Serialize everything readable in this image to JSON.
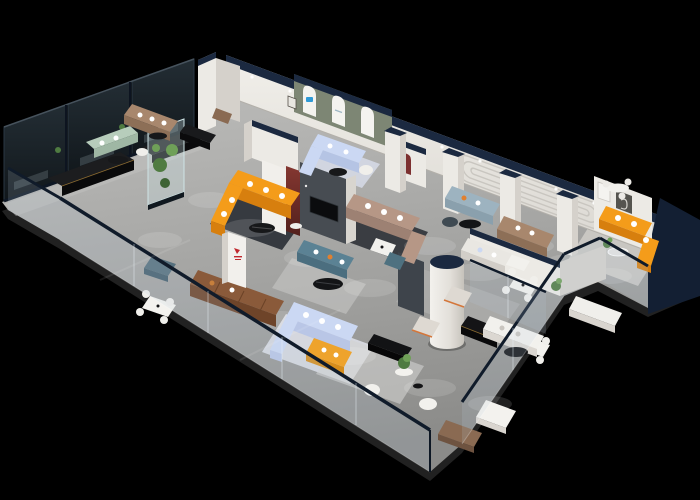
{
  "meta": {
    "description": "3D isometric cutaway render of a furniture showroom floor plan on a black background, with glass-walled display boxes, arched feature wall, glass front railing and many sofa vignettes",
    "canvas_width": "700",
    "canvas_height": "500"
  },
  "palette": {
    "background": "#000000",
    "floor_back": "#b6b6b4",
    "floor_front": "#8e8e8c",
    "slab": "#212121",
    "wall": "#eceae5",
    "wall_shade": "#d5d1cb",
    "navy": "#1b2940",
    "navy_dark": "#131f33",
    "rail": "#101b2a",
    "glass_tint": "rgba(185,208,224,0.16)",
    "glass_box": "#181f24",
    "arch_wall": "#7d8674",
    "accent_red": "#7c3030",
    "tv_wall": "#474c52",
    "sofa_orange": "#f49c1a",
    "sofa_orange_shade": "#d77f0e",
    "sofa_yellow": "#eea32c",
    "sofa_sage": "#b7cdbb",
    "sofa_tan": "#a8876d",
    "sofa_brown": "#8a5a3a",
    "sofa_lightblue": "#cbd8f3",
    "sofa_teal": "#5b8294",
    "sofa_mauve": "#b69786",
    "sofa_bluegray": "#9db3c0",
    "white_furniture": "#f2f1ed",
    "black_furniture": "#141416",
    "plant_green": "#4f7b41",
    "plant_green_light": "#6fa058",
    "wood": "#8a6a52",
    "logo_red": "#c0272d",
    "logo_blue": "#2f9ad6"
  },
  "scene": {
    "elements": [
      {
        "name": "showroom-floor",
        "color": "#a6a6a4"
      },
      {
        "name": "back-wall-with-downlights",
        "color": "#eceae5"
      },
      {
        "name": "tinted-glass-display-boxes",
        "color": "#181f24"
      },
      {
        "name": "green-arch-feature-wall",
        "color": "#7d8674"
      },
      {
        "name": "orange-l-sofa-left",
        "color": "#f49c1a"
      },
      {
        "name": "orange-l-sofa-right-end",
        "color": "#f49c1a"
      },
      {
        "name": "yellow-sofa",
        "color": "#eea32c"
      },
      {
        "name": "sage-green-sofa",
        "color": "#b7cdbb"
      },
      {
        "name": "tan-sectional-sofa",
        "color": "#a8876d"
      },
      {
        "name": "brown-leather-sofa",
        "color": "#8a5a3a"
      },
      {
        "name": "light-blue-sectionals",
        "color": "#cbd8f3"
      },
      {
        "name": "teal-sofa-with-orange-pillows",
        "color": "#5b8294"
      },
      {
        "name": "mauve-sectional-sofa",
        "color": "#b69786"
      },
      {
        "name": "blue-gray-sofa",
        "color": "#9db3c0"
      },
      {
        "name": "tv-feature-wall",
        "color": "#474c52"
      },
      {
        "name": "dark-red-accent-panel",
        "color": "#7c3030"
      },
      {
        "name": "plant-terrarium-case",
        "color": "#4f7b41"
      },
      {
        "name": "white-cylinder-column",
        "color": "#eceae5"
      },
      {
        "name": "navy-capped-pillars",
        "color": "#1b2940"
      },
      {
        "name": "glass-front-railing",
        "color": "#101b2a"
      },
      {
        "name": "red-brand-logo-mark",
        "color": "#c0272d"
      },
      {
        "name": "blue-brand-logo-mark",
        "color": "#2f9ad6"
      }
    ]
  }
}
